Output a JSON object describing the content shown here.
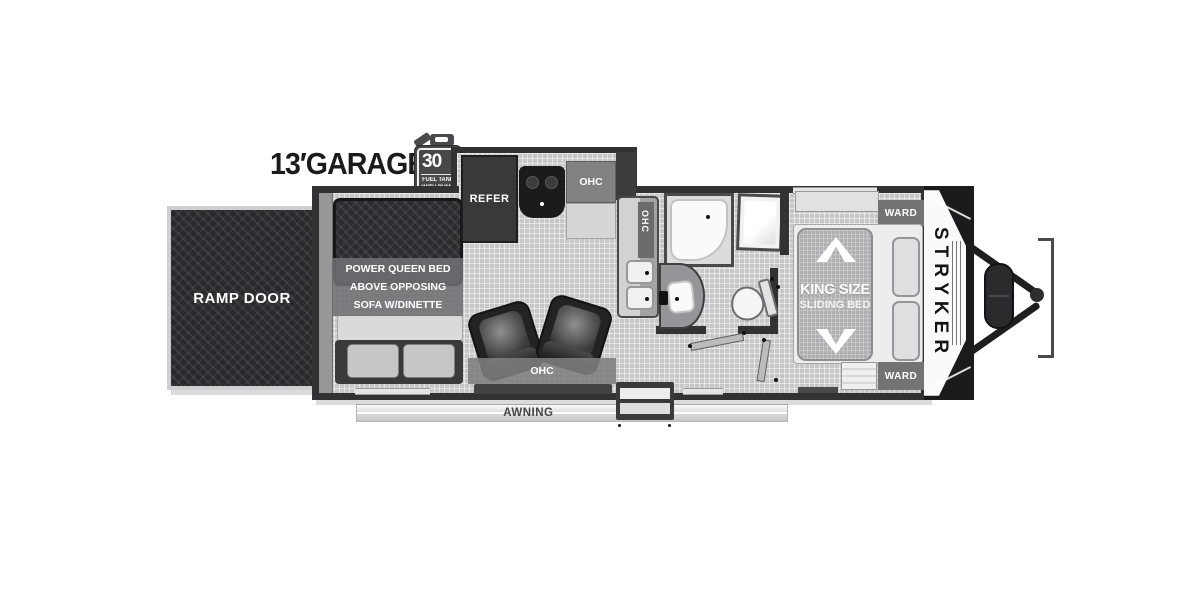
{
  "header": {
    "garage_length": "13′GARAGE",
    "fuel_badge": {
      "amount": "30",
      "unit": "GAL",
      "caption_line1": "FUEL TANK",
      "caption_line2": "WITH PUMP"
    }
  },
  "exterior": {
    "ramp_door": "RAMP DOOR",
    "awning": "AWNING",
    "brand": "STRYKER"
  },
  "garage": {
    "note": [
      "POWER QUEEN BED",
      "ABOVE OPPOSING",
      "SOFA W/DINETTE"
    ]
  },
  "kitchen": {
    "refrigerator": "REFER",
    "overhead_cabinet": "OHC",
    "counter_cabinet": "OHC"
  },
  "living": {
    "overhead_cabinet": "OHC"
  },
  "bedroom": {
    "bed_line1": "KING SIZE",
    "bed_line2": "SLIDING BED",
    "wardrobe_top": "WARD",
    "wardrobe_bottom": "WARD"
  },
  "palette": {
    "wall": "#323234",
    "floor": "#c7c7c9",
    "dark_furniture": "#29292d",
    "label_gray": "#757578",
    "text_dark": "#1b1b1d"
  }
}
